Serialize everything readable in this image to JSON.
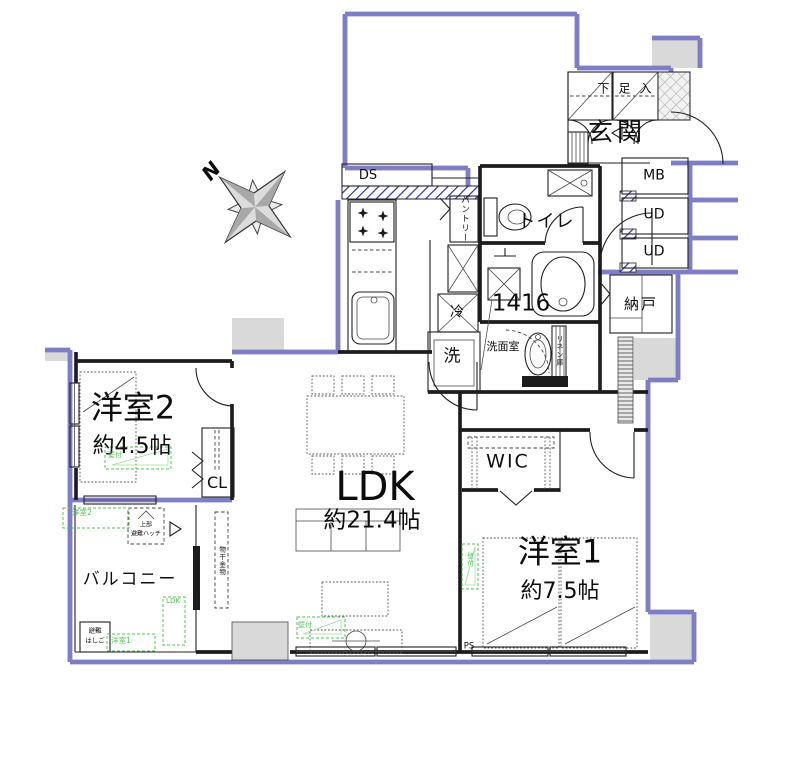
{
  "rooms": {
    "ldk": {
      "name": "LDK",
      "size": "約21.4帖"
    },
    "bedroom1": {
      "name": "洋室1",
      "size": "約7.5帖"
    },
    "bedroom2": {
      "name": "洋室2",
      "size": "約4.5帖"
    },
    "balcony": {
      "name": "バルコニー"
    },
    "entrance": {
      "name": "玄関"
    },
    "toilet": {
      "name": "トイレ"
    },
    "washroom": {
      "name": "洗面室"
    },
    "bathroom": {
      "size_label": "1416"
    },
    "storage": {
      "name": "納戸"
    },
    "wic": {
      "name": "WIC"
    },
    "closet": {
      "name": "CL"
    },
    "shoe_cabinet": {
      "name": "下足入"
    }
  },
  "fixtures": {
    "washing_machine": "洗",
    "refrigerator": "冷",
    "pantry": "パントリー",
    "linen_cabinet": "リネン庫",
    "duct_space": "DS",
    "meter_box": "MB",
    "ud_upper": "UD",
    "ud_lower": "UD",
    "pipe_space": "PS"
  },
  "annotations": {
    "north": "N",
    "escape_hatch_line1": "上部",
    "escape_hatch_line2": "避難ハッチ",
    "escape_ladder_line1": "避難",
    "escape_ladder_line2": "はしご",
    "laundry_hardware": "物干金物",
    "ac_outdoor_bedroom2": "洋室2",
    "ac_outdoor_ldk": "LDK",
    "ac_outdoor_bedroom1": "洋室1",
    "wall_mount_bedroom2": "壁付",
    "wall_mount_ldk": "壁付",
    "wall_mount_bedroom1": "壁付"
  },
  "colors": {
    "boundary_blue": "#7e7ec6",
    "hatch_blue": "#2d2db4",
    "annotation_green": "#4fc456",
    "wall_black": "#1c1c1c",
    "common_area_gray": "#d9d9d9"
  }
}
